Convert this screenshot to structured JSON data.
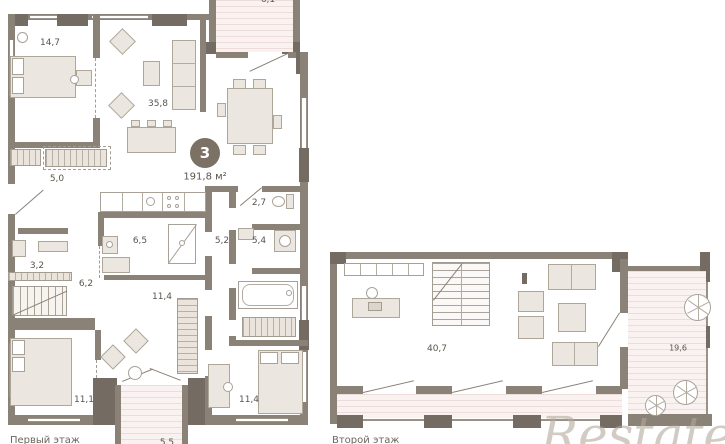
{
  "badge": {
    "rooms_count": "3",
    "total_area": "191,8 м²"
  },
  "floor1": {
    "label": "Первый этаж",
    "rooms": [
      {
        "name": "bedroom",
        "area": "14,7"
      },
      {
        "name": "living-kitchen",
        "area": "35,8"
      },
      {
        "name": "wardrobe-hall",
        "area": "5,0"
      },
      {
        "name": "wc",
        "area": "2,7"
      },
      {
        "name": "bathroom",
        "area": "6,5"
      },
      {
        "name": "hall",
        "area": "5,2"
      },
      {
        "name": "shower-room",
        "area": "5,4"
      },
      {
        "name": "closet",
        "area": "3,2"
      },
      {
        "name": "stair-hall",
        "area": "6,2"
      },
      {
        "name": "lounge",
        "area": "11,4"
      },
      {
        "name": "bedroom-2",
        "area": "11,1"
      },
      {
        "name": "bedroom-3",
        "area": "11,4"
      },
      {
        "name": "balcony",
        "area": "5,5"
      },
      {
        "name": "terrace",
        "area": "6,1"
      }
    ]
  },
  "floor2": {
    "label": "Второй этаж",
    "rooms": [
      {
        "name": "studio",
        "area": "40,7"
      },
      {
        "name": "terrace",
        "area": "19,6"
      }
    ]
  },
  "watermark": {
    "text": "Restate"
  },
  "colors": {
    "wall": "#8a8177",
    "pillar": "#746c62",
    "terrace_fill": "#faf2f1",
    "furniture_fill": "#ebe6df",
    "label_text": "#5a554d",
    "badge_bg": "#7b7164"
  }
}
